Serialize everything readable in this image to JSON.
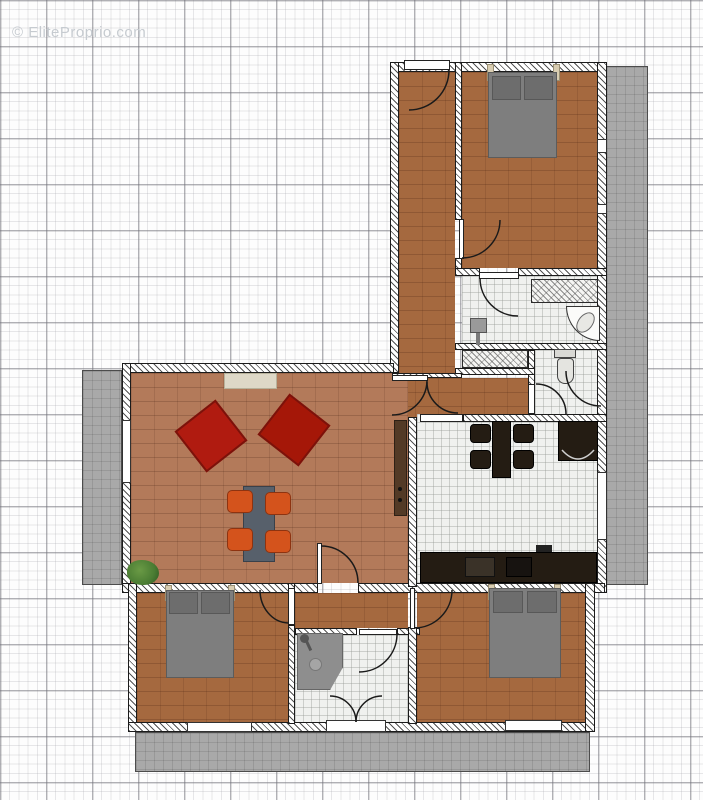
{
  "watermark": {
    "text": "© EliteProprio.com"
  },
  "plan": {
    "kind": "apartment-floor-plan",
    "rooms": [
      {
        "name": "entrance-corridor",
        "floor": "wood"
      },
      {
        "name": "bedroom-top",
        "floor": "wood"
      },
      {
        "name": "bathroom-top",
        "floor": "tile"
      },
      {
        "name": "wc",
        "floor": "tile"
      },
      {
        "name": "kitchen",
        "floor": "tile"
      },
      {
        "name": "living-room",
        "floor": "wood"
      },
      {
        "name": "hallway-junction",
        "floor": "wood"
      },
      {
        "name": "bedroom-bottom-left",
        "floor": "wood"
      },
      {
        "name": "shower-room",
        "floor": "tile"
      },
      {
        "name": "bedroom-bottom-right",
        "floor": "wood"
      },
      {
        "name": "balcony-right",
        "floor": "deck"
      },
      {
        "name": "balcony-left",
        "floor": "deck"
      },
      {
        "name": "terrace-bottom",
        "floor": "deck"
      }
    ],
    "furniture": [
      "double-bed",
      "double-bed",
      "double-bed",
      "red-armchair",
      "red-armchair",
      "coffee-table-with-4-orange-chairs",
      "kitchen-table-with-4-chairs",
      "kitchen-counter",
      "fridge",
      "sideboard",
      "plant",
      "wall-closet",
      "wall-closet",
      "pedestal-sink",
      "corner-basin",
      "toilet",
      "corner-shower",
      "sliding-door"
    ]
  },
  "colors": {
    "wood-dark": "#a5693f",
    "wood-light": "#b37a5a",
    "deck-gray": "#a9a9a9",
    "counter-dark": "#241c13",
    "armchair-red": "#b01b10",
    "chair-orange": "#d4531c",
    "table-gray": "#57606b",
    "bed-gray": "#7e7e7e",
    "shower-gray": "#8e8e8e",
    "sideboard-beige": "#ded8c7",
    "plant-green": "#4a7c33"
  }
}
